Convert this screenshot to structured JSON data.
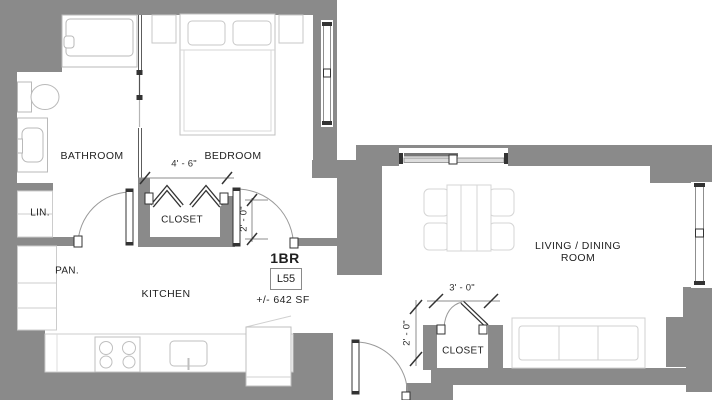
{
  "plan": {
    "unit": {
      "type_label": "1BR",
      "unit_id": "L55",
      "area": "+/- 642 SF"
    },
    "rooms": {
      "bathroom": {
        "label": "BATHROOM"
      },
      "bedroom": {
        "label": "BEDROOM"
      },
      "bedroom_closet": {
        "label": "CLOSET"
      },
      "linen": {
        "label": "LIN."
      },
      "pantry": {
        "label": "PAN."
      },
      "kitchen": {
        "label": "KITCHEN"
      },
      "living_dining": {
        "line1": "LIVING / DINING",
        "line2": "ROOM"
      },
      "entry_closet": {
        "label": "CLOSET"
      }
    },
    "dimensions": {
      "bedroom_closet_width": "4' - 6\"",
      "bedroom_door_width": "2' - 0\"",
      "entry_closet_width": "3' - 0\"",
      "entry_closet_depth": "2' - 0\""
    },
    "colors": {
      "wall": "#8a8a8a",
      "fixture_line": "#b9b9b9",
      "furniture_line": "#cccccc",
      "text": "#1f1f1f"
    }
  }
}
